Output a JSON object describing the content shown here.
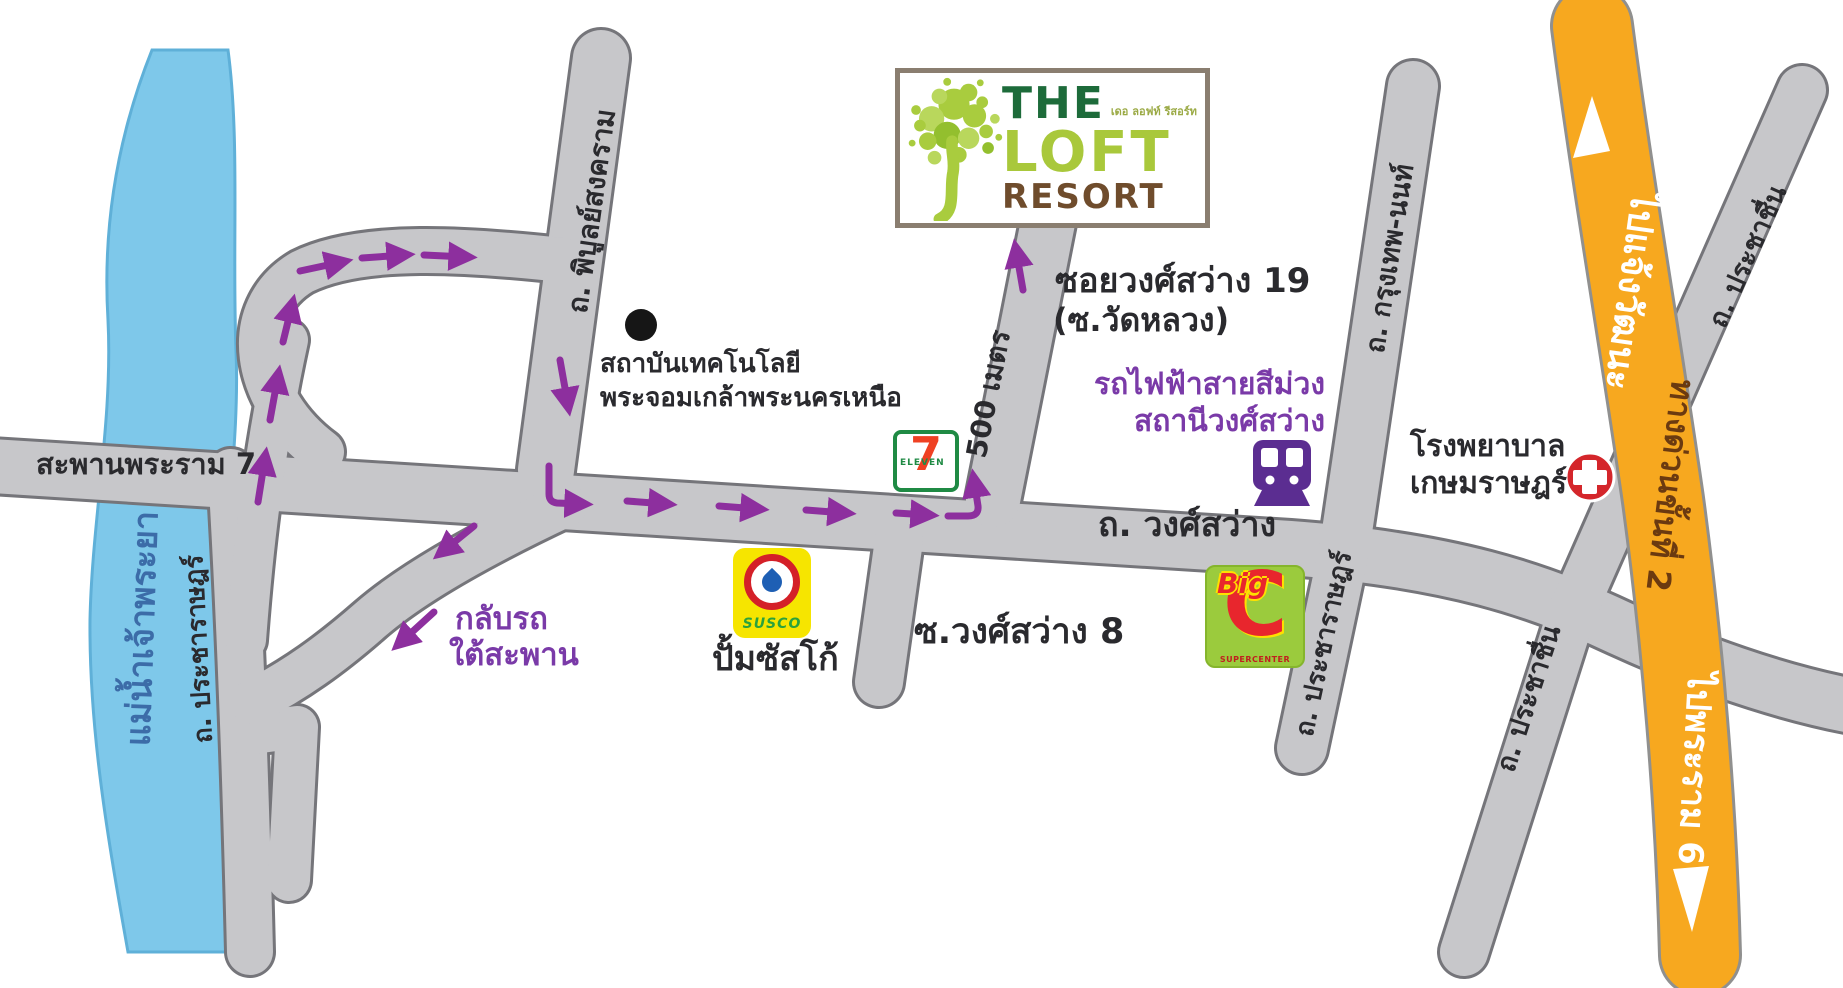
{
  "title": "The Loft Resort location map",
  "colors": {
    "river": "#7ec8ea",
    "road_fill": "#c7c7ca",
    "road_edge": "#75757a",
    "expressway_orange": "#f7a81f",
    "route_arrow_purple": "#8d2f9e",
    "mrt_purple": "#7a3aa8",
    "logo_green": "#a9c83b",
    "logo_brown": "#6f4c2c"
  },
  "logo": {
    "the": "THE",
    "loft": "LOFT",
    "resort": "RESORT",
    "tagline_thai": "เดอ ลอฟท์ รีสอร์ท"
  },
  "roads": {
    "rama7_bridge": "สะพานพระราม 7",
    "wongsawang": "ถ. วงศ์สว่าง",
    "pibulsongkram": "ถ. พิบูลย์สงคราม",
    "pracharat_west": "ถ. ประชาราษฎร์",
    "pracharat_east": "ถ. ประชาราษฎร์",
    "krungthep_non": "ถ. กรุงเทพ-นนท์",
    "prachachuen_north": "ถ. ประชาชื่น",
    "prachachuen_south": "ถ. ประชาชื่น",
    "soi_wongsawang_8": "ซ.วงศ์สว่าง 8",
    "soi_wongsawang_19_line1": "ซอยวงศ์สว่าง 19",
    "soi_wongsawang_19_line2": "(ซ.วัดหลวง)",
    "soi_distance": "500 เมตร",
    "expressway_to_north": "ไปแจ้งวัฒนะ",
    "expressway_name": "ทางด่วนขั้นที่ 2",
    "expressway_to_south": "ไปพระราม 6"
  },
  "places": {
    "river": "แม่น้ำเจ้าพระยา",
    "institute_line1": "สถาบันเทคโนโลยี",
    "institute_line2": "พระจอมเกล้าพระนครเหนือ",
    "uturn_line1": "กลับรถ",
    "uturn_line2": "ใต้สะพาน",
    "susco_label": "ปั้มซัสโก้",
    "mrt_line1": "รถไฟฟ้าสายสีม่วง",
    "mrt_line2": "สถานีวงศ์สว่าง",
    "hospital_line1": "โรงพยาบาล",
    "hospital_line2": "เกษมราษฎร์"
  },
  "brand_icons": {
    "seven_eleven_7": "7",
    "seven_eleven_text": "ELEVEN",
    "susco": "SUSCO",
    "bigc_big": "Big",
    "bigc_c": "C",
    "bigc_sub": "SUPERCENTER"
  }
}
